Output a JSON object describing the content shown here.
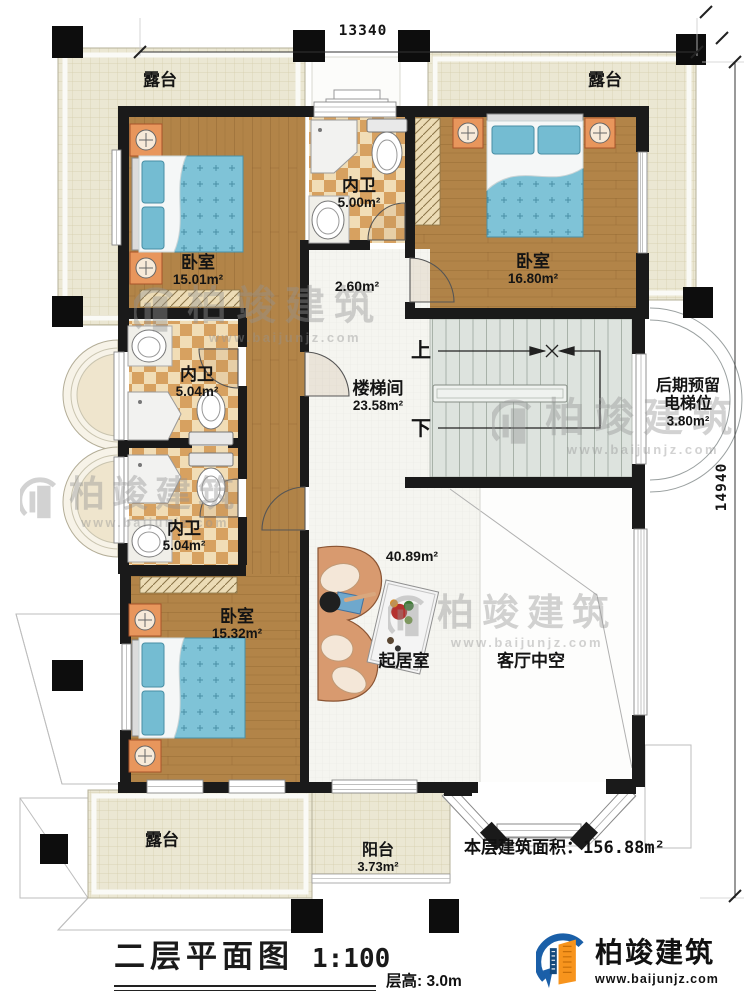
{
  "dimensions": {
    "top": "13340",
    "right": "14940"
  },
  "rooms": {
    "terrace_tl": {
      "name": "露台"
    },
    "terrace_tr": {
      "name": "露台"
    },
    "bedroom_tl": {
      "name": "卧室",
      "area": "15.01m²"
    },
    "bath_top": {
      "name": "内卫",
      "area": "5.00m²"
    },
    "bedroom_tr": {
      "name": "卧室",
      "area": "16.80m²"
    },
    "corridor": {
      "area": "2.60m²"
    },
    "stairwell": {
      "name": "楼梯间",
      "area": "23.58m²"
    },
    "elevator": {
      "line1": "后期预留",
      "line2": "电梯位",
      "area": "3.80m²"
    },
    "bath_mid_upper": {
      "name": "内卫",
      "area": "5.04m²"
    },
    "bath_mid_lower": {
      "name": "内卫",
      "area": "5.04m²"
    },
    "bedroom_bl": {
      "name": "卧室",
      "area": "15.32m²"
    },
    "living": {
      "name": "起居室",
      "area": "40.89m²"
    },
    "void": {
      "name": "客厅中空"
    },
    "terrace_bottom": {
      "name": "露台"
    },
    "balcony": {
      "name": "阳台",
      "area": "3.73m²"
    }
  },
  "stairs": {
    "up": "上",
    "down": "下"
  },
  "summary": {
    "floor_area_label": "本层建筑面积：",
    "floor_area_value": "156.88m²"
  },
  "titleblock": {
    "title": "二层平面图",
    "scale": "1:100",
    "floor_height": "层高: 3.0m"
  },
  "branding": {
    "name": "柏竣建筑",
    "url": "www.baijunjz.com"
  },
  "watermark": {
    "name": "柏竣建筑",
    "url": "www.baijunjz.com"
  }
}
